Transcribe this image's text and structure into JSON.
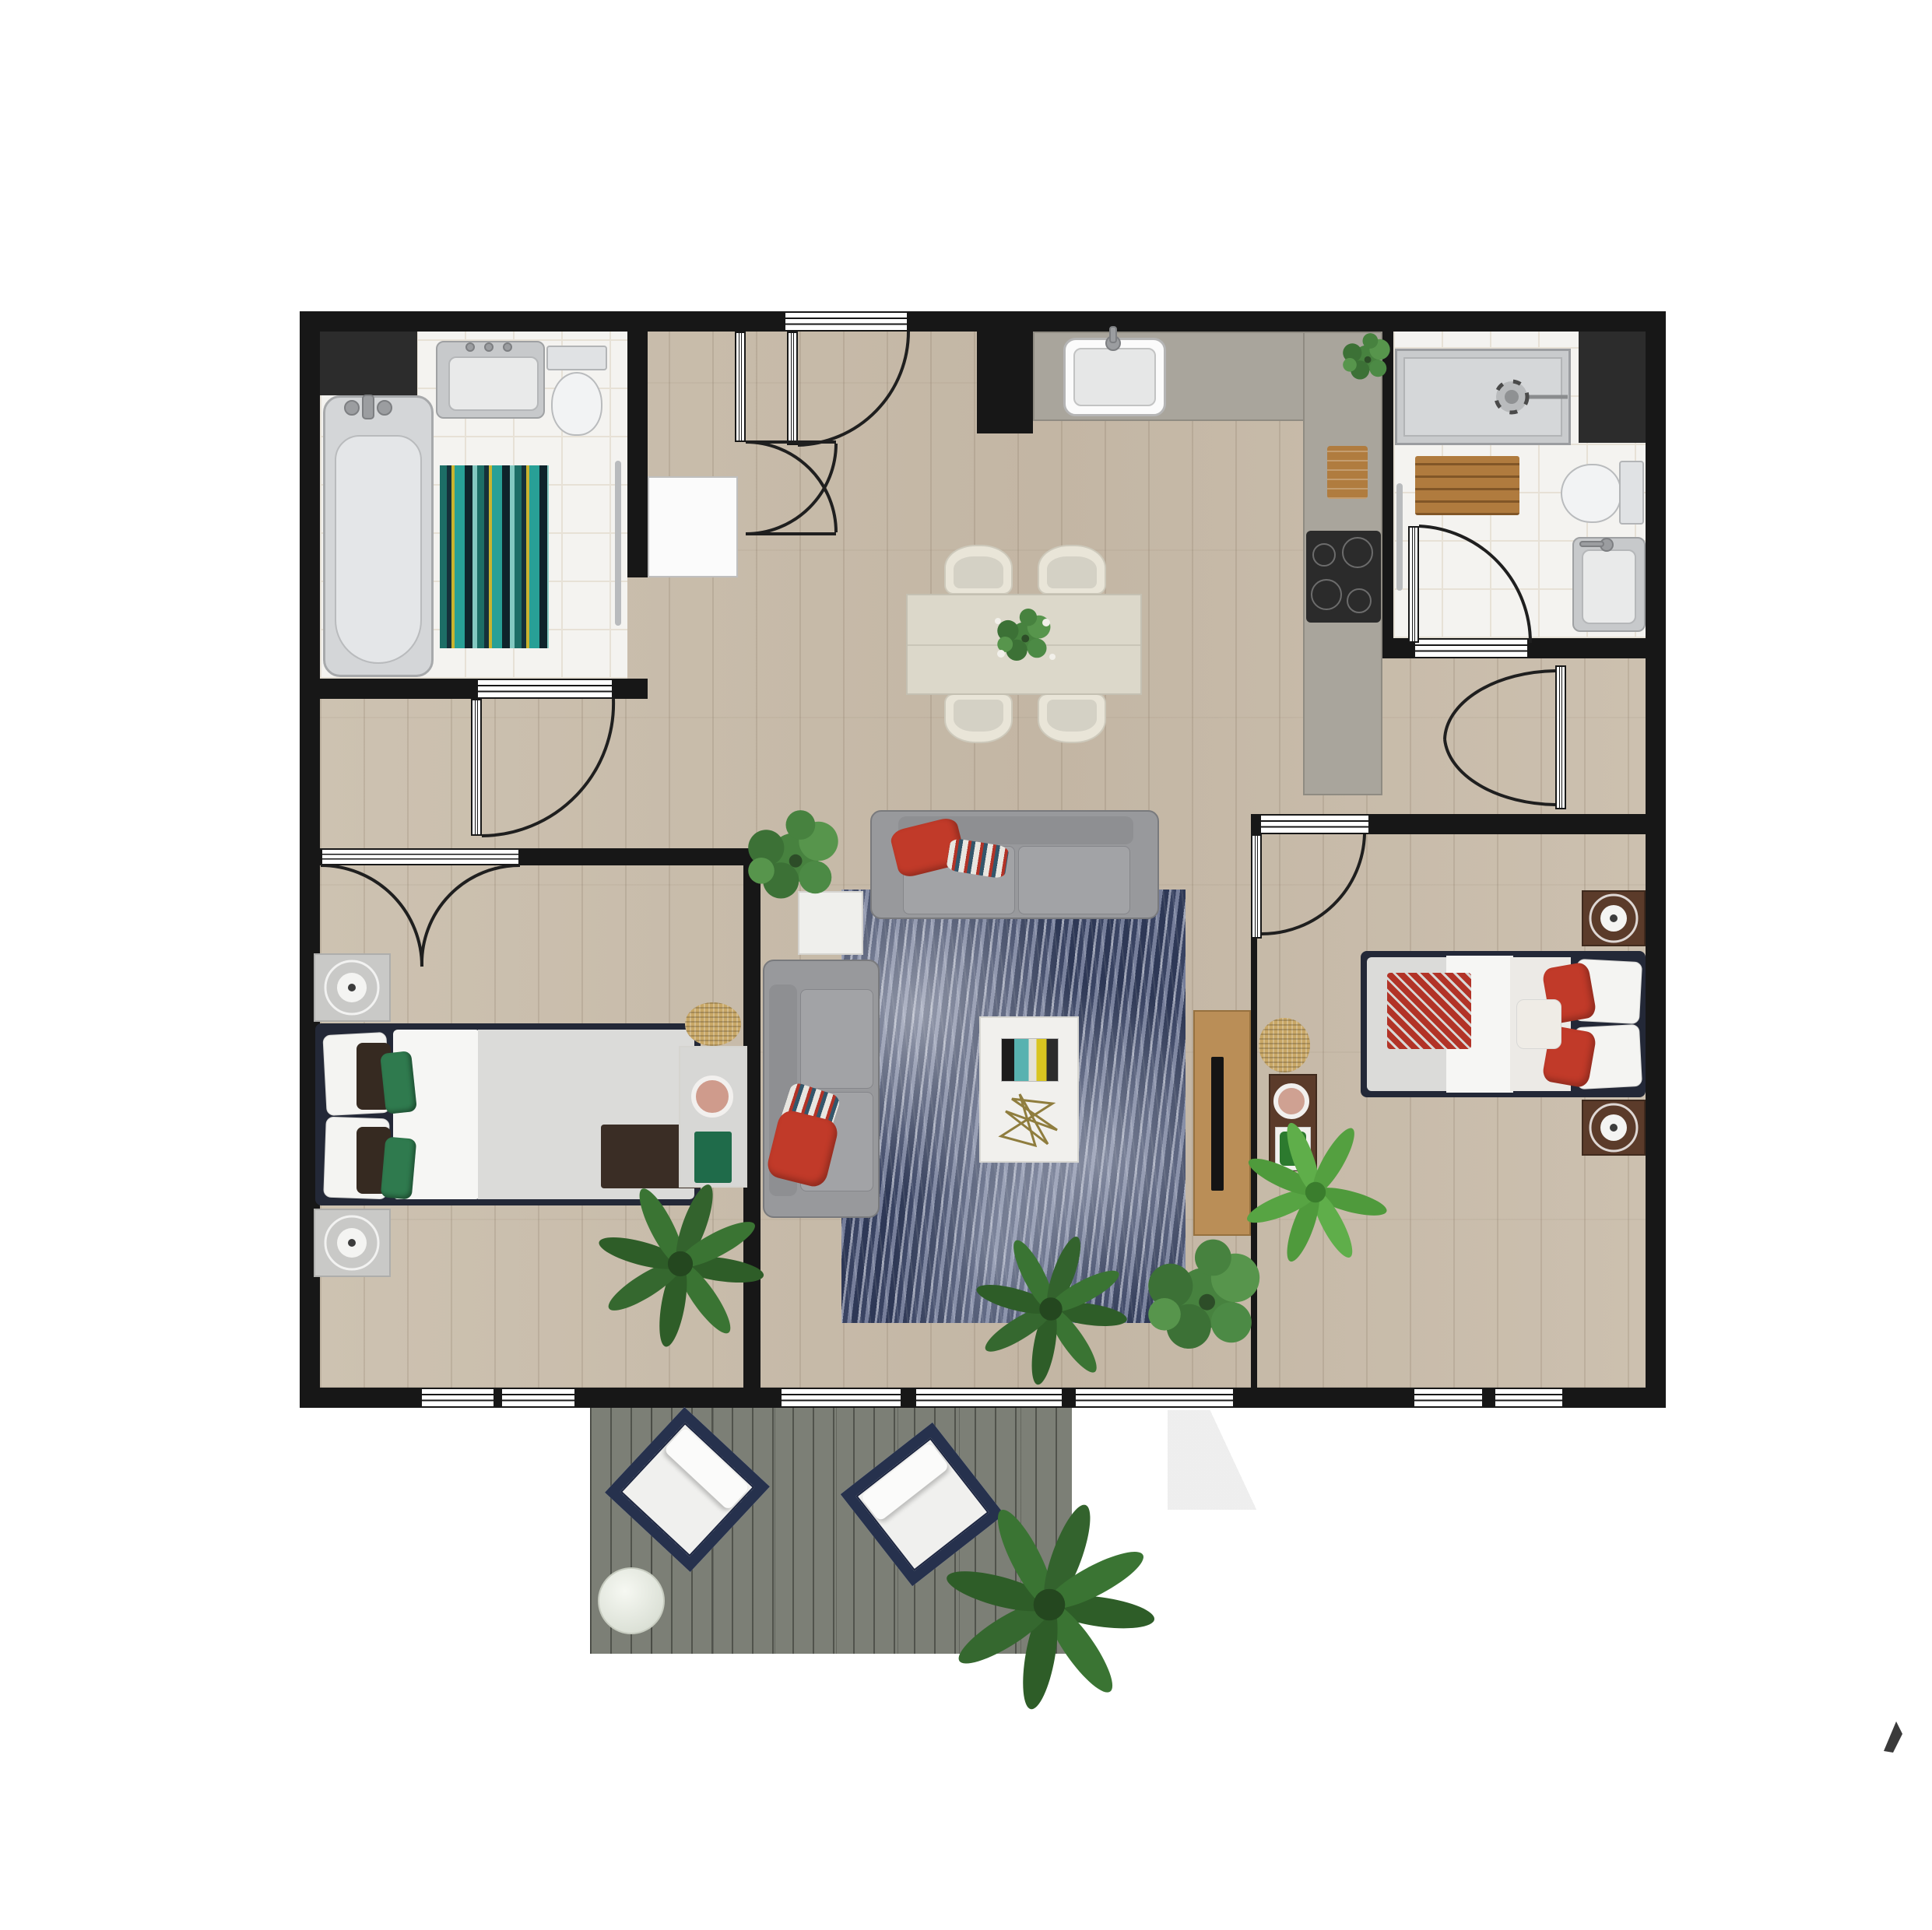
{
  "title": "Two-bedroom apartment floor plan with deck (top-down 2D render)",
  "palette": {
    "wall": "#171717",
    "wood_floor": "#c8bcab",
    "tile_floor": "#f4f3f0",
    "kitchen_counter": "#a9a59c",
    "deck": "#7c7f76",
    "sofa_gray": "#98999c",
    "accent_red": "#c13a29",
    "bed_frame_navy": "#232837",
    "rug_navy": "#4c5677",
    "dark_wood": "#5b3b2a",
    "light_wood": "#ba8e57",
    "plant_green": "#3a7433",
    "jute": "#c8a766"
  },
  "rooms": [
    {
      "name": "Bathroom 1 (bathtub bathroom, top-left)",
      "furniture": [
        "bathtub",
        "vanity sink",
        "toilet",
        "striped bath rug",
        "towel rail",
        "service shaft"
      ]
    },
    {
      "name": "Entry hall with storage niche",
      "furniture": [
        "entry door",
        "closet doors",
        "washer / cabinet"
      ]
    },
    {
      "name": "Kitchen and dining area",
      "furniture": [
        "L-shaped counter",
        "kitchen sink",
        "cooktop with 4 burners",
        "cutting board",
        "counter plant",
        "dining table with centerpiece",
        "4 dining chairs"
      ]
    },
    {
      "name": "Bathroom 2 (shower bathroom, top-right)",
      "furniture": [
        "walk-in shower",
        "toilet",
        "vanity sink",
        "wooden duckboard mat",
        "towel rail",
        "service shaft"
      ]
    },
    {
      "name": "Living room",
      "furniture": [
        "three-seat sofa",
        "two-seat sofa",
        "mottled navy area rug",
        "white coffee table with book and wire sculpture",
        "white side table",
        "TV sideboard with TV",
        "fiddle-leaf plants",
        "palm plant"
      ]
    },
    {
      "name": "Bedroom 1 (left)",
      "furniture": [
        "double bed with green pillows",
        "2 light nightstands with lamps",
        "dresser with bowl and book",
        "jute pouf",
        "palm plant",
        "french double doors"
      ]
    },
    {
      "name": "Bedroom 2 (right)",
      "furniture": [
        "double bed with red pillows",
        "2 dark nightstands with lamps",
        "side table with bowl and planter",
        "jute pouf",
        "palm plant"
      ]
    },
    {
      "name": "Deck / patio",
      "furniture": [
        "2 lounge chairs with white cushions",
        "round marble side table",
        "large potted plant"
      ]
    }
  ],
  "annotations": {
    "cursor": "small dark pointer glyph near bottom-right corner"
  }
}
